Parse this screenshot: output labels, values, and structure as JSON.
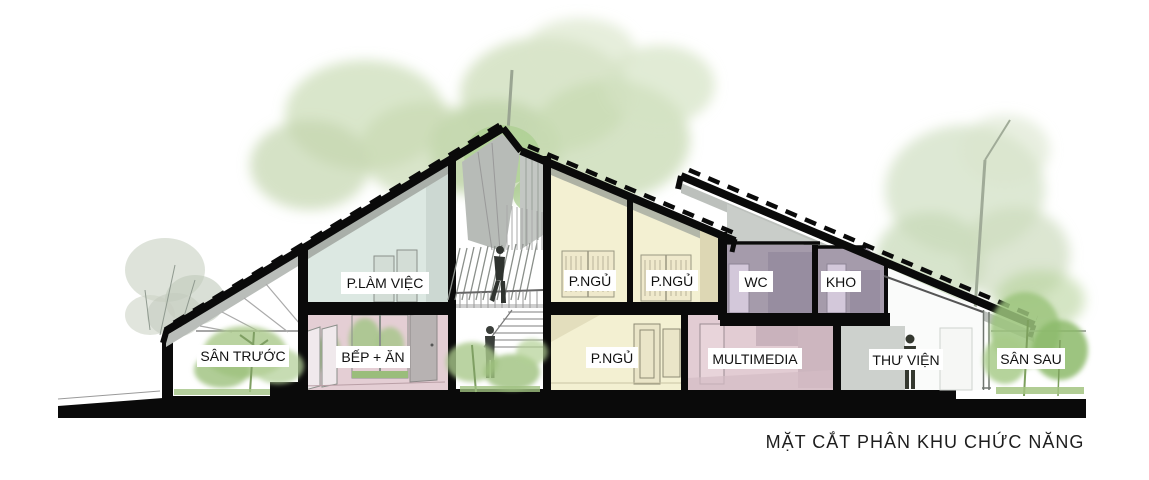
{
  "title": "MẶT CẮT PHÂN KHU CHỨC NĂNG",
  "diagram_type": "architectural-cross-section",
  "rooms": {
    "san_truoc": {
      "label": "SÂN TRƯỚC",
      "floor": "ground"
    },
    "bep_an": {
      "label": "BẾP + ĂN",
      "floor": "ground"
    },
    "p_lam_viec": {
      "label": "P.LÀM VIỆC",
      "floor": "upper"
    },
    "p_ngu_u1": {
      "label": "P.NGỦ",
      "floor": "upper"
    },
    "p_ngu_u2": {
      "label": "P.NGỦ",
      "floor": "upper"
    },
    "wc": {
      "label": "WC",
      "floor": "upper"
    },
    "kho": {
      "label": "KHO",
      "floor": "upper"
    },
    "p_ngu_low": {
      "label": "P.NGỦ",
      "floor": "ground"
    },
    "multimedia": {
      "label": "MULTIMEDIA",
      "floor": "ground"
    },
    "thu_vien": {
      "label": "THƯ VIỆN",
      "floor": "ground"
    },
    "san_sau": {
      "label": "SÂN SAU",
      "floor": "ground"
    }
  },
  "colors": {
    "cut_black": "#0a0a0a",
    "work": "#dce8e2",
    "kitchen": "#e4ced4",
    "bedroom": "#f3f0d2",
    "utility": "#a59bab",
    "utility_door": "#d3c8da",
    "multimedia": "#e2ccd3",
    "library_wall": "#cdd1cd",
    "roof_underside": "#b9bdb9",
    "foliage": "#c8dab4",
    "foliage_bright": "#9cc47c"
  }
}
